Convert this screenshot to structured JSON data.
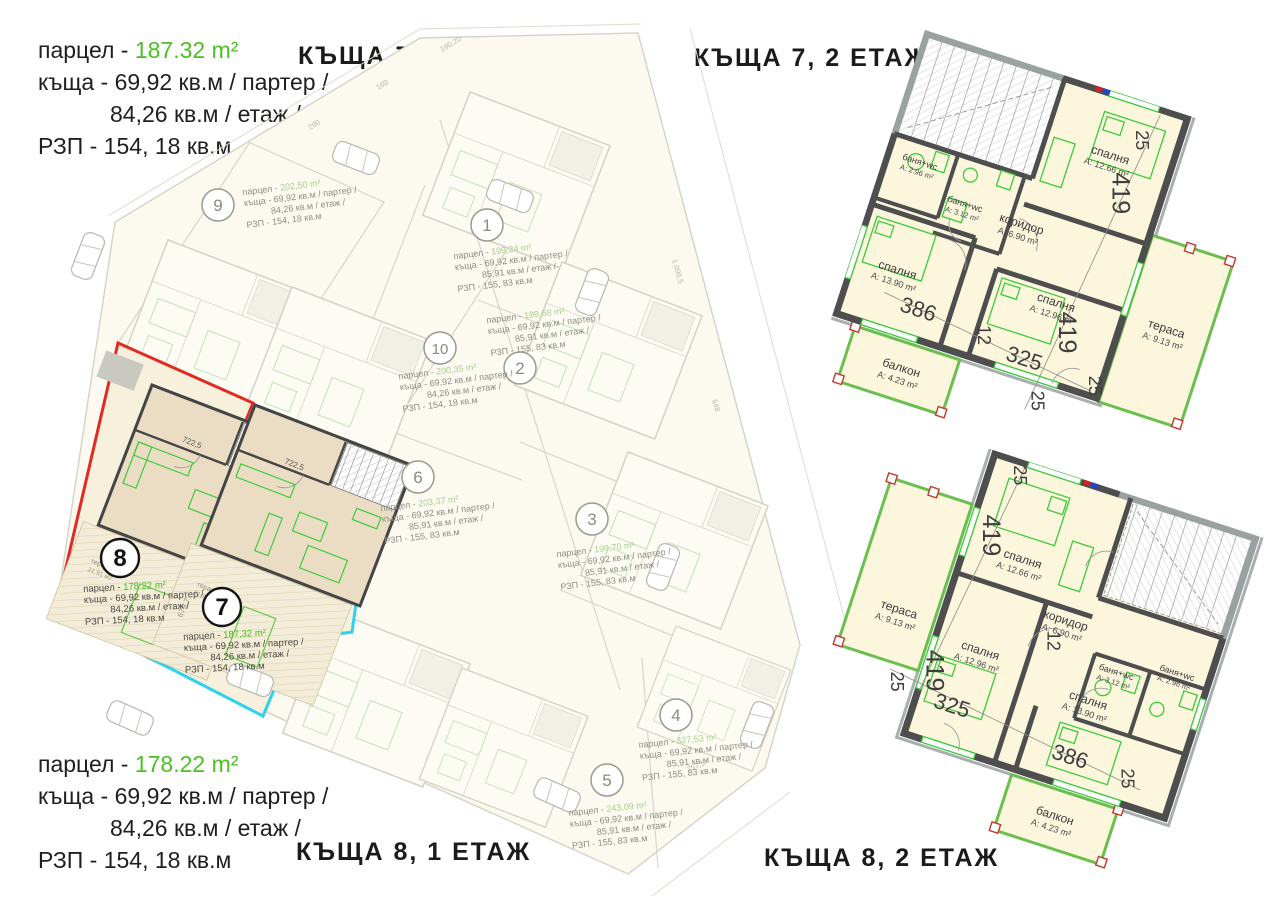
{
  "titles": {
    "house7_floor1": "КЪЩА 7, 1 ЕТАЖ",
    "house7_floor2": "КЪЩА 7, 2 ЕТАЖ",
    "house8_floor1": "КЪЩА 8, 1 ЕТАЖ",
    "house8_floor2": "КЪЩА 8, 2 ЕТАЖ"
  },
  "header": {
    "house7_info": {
      "parcel_label": "парцел - ",
      "parcel_value": "187.32 m²",
      "house_line": "къща - 69,92 кв.м / партер /",
      "floor_line": "84,26 кв.м / етаж /",
      "rzp_line": "РЗП - 154, 18 кв.м"
    },
    "house8_info": {
      "parcel_label": "парцел - ",
      "parcel_value": "178.22 m²",
      "house_line": "къща - 69,92 кв.м / партер /",
      "floor_line": "84,26 кв.м / етаж /",
      "rzp_line": "РЗП - 154, 18 кв.м"
    }
  },
  "site_plan": {
    "plots": [
      {
        "num": "9",
        "pl": "парцел - ",
        "pv": "202,50 m²",
        "l2": "къща - 69,92 кв.м / партер /",
        "l3": "84,26 кв.м / етаж /",
        "l4": "РЗП - 154, 18 кв.м"
      },
      {
        "num": "1",
        "pl": "парцел - ",
        "pv": "199,24 m²",
        "l2": "къща - 69,92 кв.м / партер /",
        "l3": "85,91 кв.м / етаж /",
        "l4": "РЗП - 155, 83 кв.м"
      },
      {
        "num": "10",
        "pl": "парцел - ",
        "pv": "200,35 m²",
        "l2": "къща - 69,92 кв.м / партер /",
        "l3": "84,26 кв.м / етаж /",
        "l4": "РЗП - 154, 18 кв.м"
      },
      {
        "num": "2",
        "pl": "парцел - ",
        "pv": "199,68 m²",
        "l2": "къща - 69,92 кв.м / партер /",
        "l3": "85,91 кв.м / етаж /",
        "l4": "РЗП - 155, 83 кв.м"
      },
      {
        "num": "6",
        "pl": "парцел - ",
        "pv": "203,37 m²",
        "l2": "къща - 69,92 кв.м / партер /",
        "l3": "85,91 кв.м / етаж /",
        "l4": "РЗП - 155, 83 кв.м"
      },
      {
        "num": "3",
        "pl": "парцел - ",
        "pv": "199,70 m²",
        "l2": "къща - 69,92 кв.м / партер /",
        "l3": "85,91 кв.м / етаж /",
        "l4": "РЗП - 155, 83 кв.м"
      },
      {
        "num": "8",
        "pl": "парцел - ",
        "pv": "178.22 m²",
        "l2": "къща - 69,92 кв.м / партер /",
        "l3": "84,26 кв.м / етаж /",
        "l4": "РЗП - 154, 18 кв.м"
      },
      {
        "num": "7",
        "pl": "парцел - ",
        "pv": "187,32 m²",
        "l2": "къща - 69,92 кв.м / партер /",
        "l3": "84,26 кв.м / етаж /",
        "l4": "РЗП - 154, 18 кв.м"
      },
      {
        "num": "4",
        "pl": "парцел - ",
        "pv": "327,53 m²",
        "l2": "къща - 69,92 кв.м / партер /",
        "l3": "85,91 кв.м / етаж /",
        "l4": "РЗП - 155, 83 кв.м"
      },
      {
        "num": "5",
        "pl": "парцел - ",
        "pv": "243,09 m²",
        "l2": "къща - 69,92 кв.м / партер /",
        "l3": "85,91 кв.м / етаж /",
        "l4": "РЗП - 155, 83 кв.м"
      }
    ],
    "house_dim": "722,5",
    "border_dim": "679,7",
    "terrace_label": "тераса",
    "terrace_area": "21,91 м2",
    "road_dims": [
      "290",
      "100",
      "190.20",
      "1.090,5",
      "648",
      "757,5"
    ]
  },
  "floor_plan_rooms": {
    "bedroom_12_66": {
      "name": "спалня",
      "area": "A: 12.66 m²"
    },
    "bedroom_12_96": {
      "name": "спалня",
      "area": "A: 12.96 m²"
    },
    "bedroom_13_90": {
      "name": "спалня",
      "area": "A: 13.90 m²"
    },
    "corridor": {
      "name": "коридор",
      "area": "A: 6.90 m²"
    },
    "bath_2_96": {
      "name": "баня+wc",
      "area": "A: 2.96 m²"
    },
    "bath_3_12": {
      "name": "баня+wc",
      "area": "A: 3.12 m²"
    },
    "terrace": {
      "name": "тераса",
      "area": "A: 9.13 m²"
    },
    "balcony": {
      "name": "балкон",
      "area": "A: 4.23 m²"
    }
  },
  "dims": {
    "d419": "419",
    "d386": "386",
    "d325": "325",
    "d25": "25",
    "d12": "12"
  },
  "colors": {
    "accent_green": "#4bbf24",
    "plot8_outline": "#e02a22",
    "plot7_outline": "#2fd2ee"
  }
}
